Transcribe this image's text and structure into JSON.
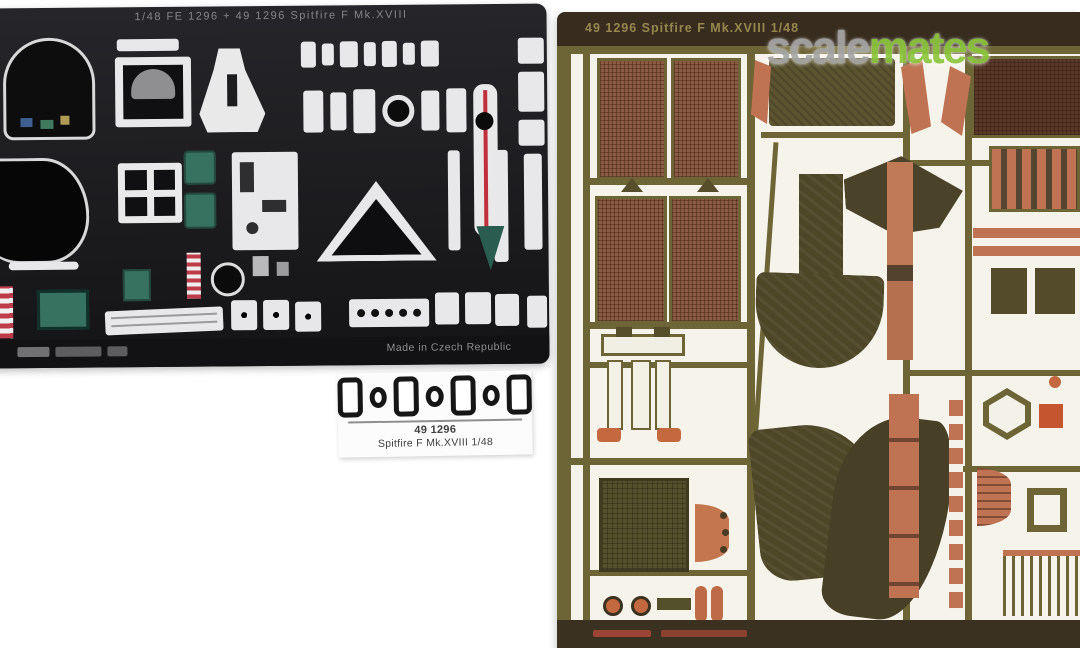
{
  "watermark": {
    "gray_text": "scale",
    "green_text": "mates"
  },
  "fret_left": {
    "header_text": "1/48  FE 1296 + 49 1296  Spitfire F Mk.XVIII",
    "footer_text": "Made in Czech Republic",
    "parts": [
      "instrument-panel",
      "dial-film-frame",
      "gun-sight-triangle",
      "seatbelt-buckles",
      "placards-teal",
      "thermometer-strip",
      "striped-warning-strips",
      "headrest-blank"
    ]
  },
  "fret_right": {
    "header_text": "49 1296    Spitfire F Mk.XVIII    1/48",
    "parts": [
      "radiator-mesh-pair-1",
      "radiator-mesh-pair-2",
      "carburettor-intake-fairing",
      "radiator-flap",
      "exhaust-shroud",
      "ladder-frame",
      "grille-louvres",
      "copper-strips"
    ]
  },
  "label": {
    "line1": "49 1296",
    "line2": "Spitfire F Mk.XVIII  1/48"
  },
  "colors": {
    "fret-dark": "#1d1d1f",
    "fret-olive": "#6e6537",
    "band-brown": "#372c1e",
    "band-text": "#97874e",
    "mesh-brown": "#8a5a42",
    "mesh-dark": "#5a3827",
    "copper": "#bf7352",
    "orange": "#c4693f",
    "olive-part": "#4d4627",
    "teal": "#37715f",
    "stripe-red": "#c03b4a",
    "logo-gray": "#a7a7a7",
    "logo-green": "#8dc63f"
  }
}
